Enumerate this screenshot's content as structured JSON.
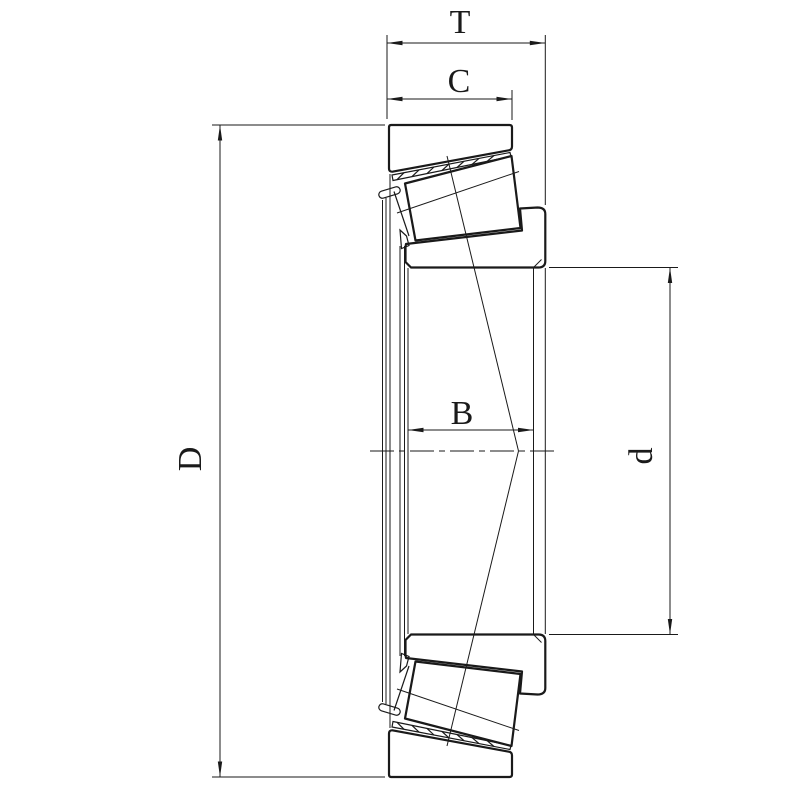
{
  "drawing": {
    "background_color": "#ffffff",
    "line_color": "#1a1a1a",
    "dimensions": [
      {
        "id": "total-width",
        "label": "T"
      },
      {
        "id": "cup-width",
        "label": "C"
      },
      {
        "id": "cone-width",
        "label": "B"
      },
      {
        "id": "outer-diameter",
        "label": "D"
      },
      {
        "id": "bore-diameter",
        "label": "d"
      }
    ]
  }
}
